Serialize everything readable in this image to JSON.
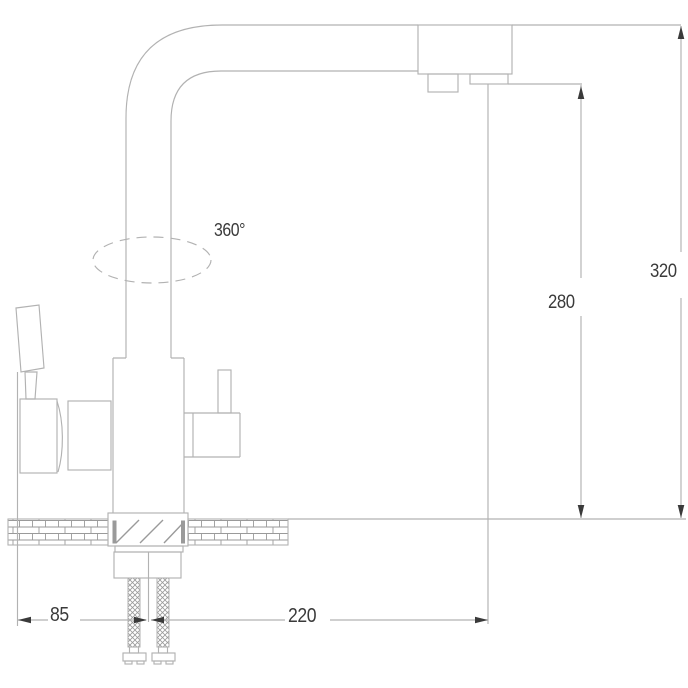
{
  "labels": {
    "swivel": "360°",
    "spout_height": "280",
    "overall_height": "320",
    "handle_offset": "85",
    "spout_reach": "220"
  },
  "colors": {
    "bg": "#ffffff",
    "line": "#b2b2b2",
    "hatch": "#9a9a9a",
    "ink": "#3a3a3a"
  }
}
